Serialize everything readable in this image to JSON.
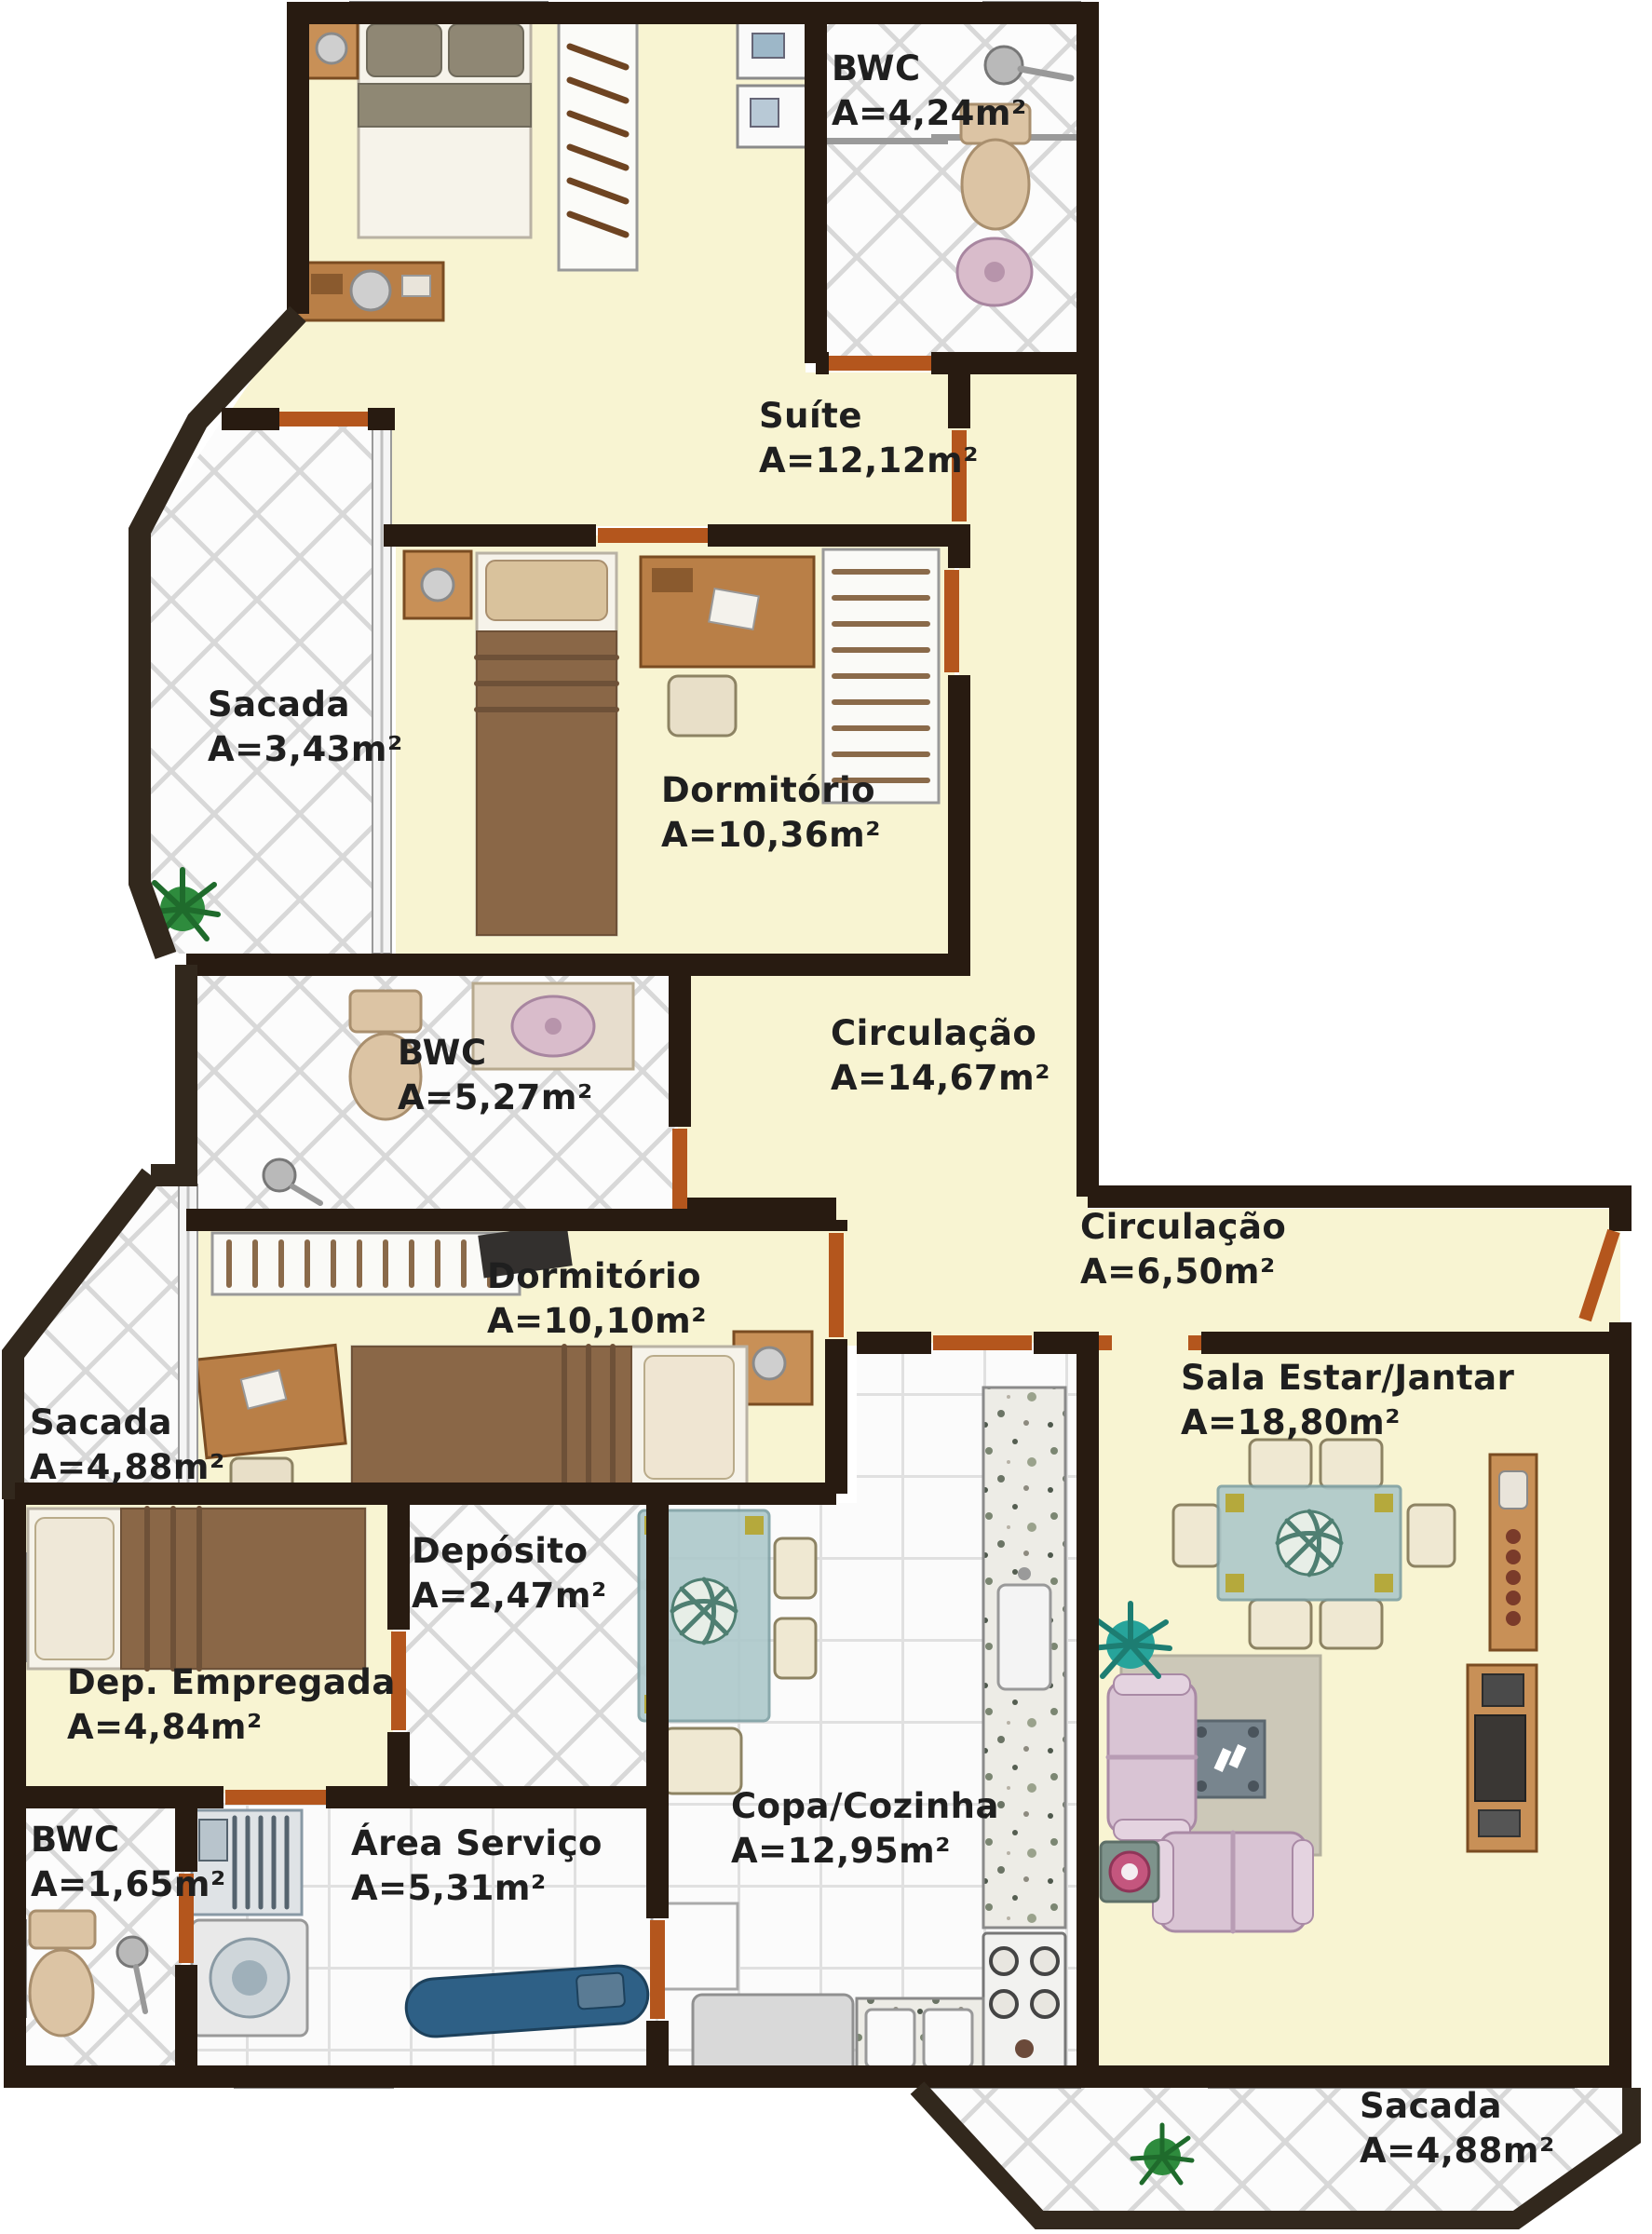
{
  "figure_type": "apartment-floor-plan",
  "rooms": [
    {
      "id": "bwc-suite",
      "name": "BWC",
      "area": "A=4,24m²",
      "label_x": 893,
      "label_y": 100
    },
    {
      "id": "suite",
      "name": "Suíte",
      "area": "A=12,12m²",
      "label_x": 815,
      "label_y": 473
    },
    {
      "id": "sacada-suite",
      "name": "Sacada",
      "area": "A=3,43m²",
      "label_x": 223,
      "label_y": 783
    },
    {
      "id": "dormitorio-1",
      "name": "Dormitório",
      "area": "A=10,36m²",
      "label_x": 710,
      "label_y": 875
    },
    {
      "id": "bwc-social",
      "name": "BWC",
      "area": "A=5,27m²",
      "label_x": 427,
      "label_y": 1157
    },
    {
      "id": "circulacao-1",
      "name": "Circulação",
      "area": "A=14,67m²",
      "label_x": 892,
      "label_y": 1136
    },
    {
      "id": "circulacao-2",
      "name": "Circulação",
      "area": "A=6,50m²",
      "label_x": 1160,
      "label_y": 1344
    },
    {
      "id": "dormitorio-2",
      "name": "Dormitório",
      "area": "A=10,10m²",
      "label_x": 523,
      "label_y": 1397
    },
    {
      "id": "sacada-esquerda",
      "name": "Sacada",
      "area": "A=4,88m²",
      "label_x": 32,
      "label_y": 1554
    },
    {
      "id": "sala-estar-jantar",
      "name": "Sala Estar/Jantar",
      "area": "A=18,80m²",
      "label_x": 1268,
      "label_y": 1506
    },
    {
      "id": "deposito",
      "name": "Depósito",
      "area": "A=2,47m²",
      "label_x": 442,
      "label_y": 1692
    },
    {
      "id": "dep-empregada",
      "name": "Dep. Empregada",
      "area": "A=4,84m²",
      "label_x": 72,
      "label_y": 1833
    },
    {
      "id": "bwc-servico",
      "name": "BWC",
      "area": "A=1,65m²",
      "label_x": 33,
      "label_y": 2002
    },
    {
      "id": "area-servico",
      "name": "Área Serviço",
      "area": "A=5,31m²",
      "label_x": 377,
      "label_y": 2006
    },
    {
      "id": "copa-cozinha",
      "name": "Copa/Cozinha",
      "area": "A=12,95m²",
      "label_x": 785,
      "label_y": 1966
    },
    {
      "id": "sacada-inferior",
      "name": "Sacada",
      "area": "A=4,88m²",
      "label_x": 1460,
      "label_y": 2288
    }
  ],
  "palette": {
    "wall": "#281b11",
    "outer_balcony_wall": "#32281d",
    "floor_yellow": "#f8f4d2",
    "tile_white": "#fcfcfc",
    "tile_grout": "#d8d8d8",
    "door_orange": "#b4561d",
    "granite_counter": "#edece6",
    "wood": "#b97f47",
    "sofa_pink": "#d9c4d4",
    "glass_table": "#abc7ca",
    "blanket_brown": "#8a6747"
  }
}
